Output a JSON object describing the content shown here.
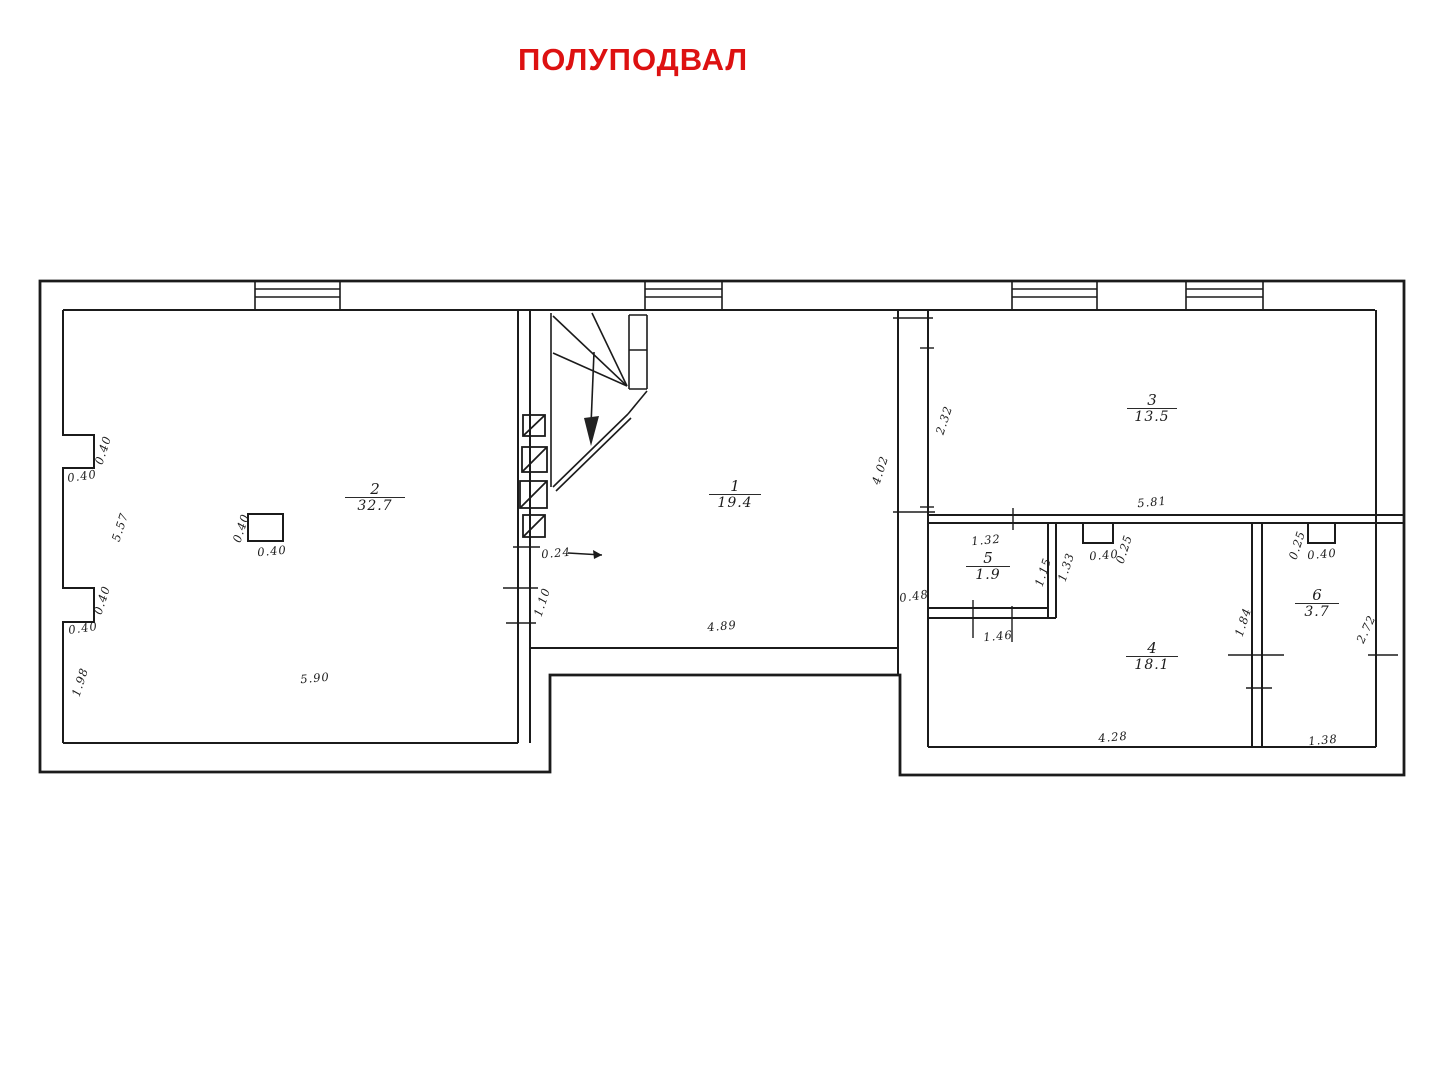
{
  "title": "ПОЛУПОДВАЛ",
  "colors": {
    "title_red": "#dd1111",
    "ink": "#1b1b1b",
    "background": "#ffffff"
  },
  "plan": {
    "floor_name": "ПОЛУПОДВАЛ",
    "rooms": [
      {
        "number": "1",
        "area": "19.4",
        "x": 735,
        "y": 495,
        "bar_w": 52
      },
      {
        "number": "2",
        "area": "32.7",
        "x": 375,
        "y": 498,
        "bar_w": 60
      },
      {
        "number": "3",
        "area": "13.5",
        "x": 1152,
        "y": 409,
        "bar_w": 50
      },
      {
        "number": "4",
        "area": "18.1",
        "x": 1152,
        "y": 657,
        "bar_w": 52
      },
      {
        "number": "5",
        "area": "1.9",
        "x": 988,
        "y": 567,
        "bar_w": 44
      },
      {
        "number": "6",
        "area": "3.7",
        "x": 1317,
        "y": 604,
        "bar_w": 44
      }
    ],
    "dimensions": [
      {
        "text": "0.40",
        "x": 103,
        "y": 450,
        "rot": -72
      },
      {
        "text": "0.40",
        "x": 82,
        "y": 476,
        "rot": -8
      },
      {
        "text": "5.57",
        "x": 120,
        "y": 527,
        "rot": -72
      },
      {
        "text": "0.40",
        "x": 102,
        "y": 600,
        "rot": -72
      },
      {
        "text": "0.40",
        "x": 83,
        "y": 628,
        "rot": -8
      },
      {
        "text": "1.98",
        "x": 80,
        "y": 682,
        "rot": -72
      },
      {
        "text": "5.90",
        "x": 315,
        "y": 678,
        "rot": -5
      },
      {
        "text": "0.40",
        "x": 241,
        "y": 528,
        "rot": -72
      },
      {
        "text": "0.40",
        "x": 272,
        "y": 551,
        "rot": -5
      },
      {
        "text": "0.24",
        "x": 556,
        "y": 553,
        "rot": -5
      },
      {
        "text": "1.10",
        "x": 542,
        "y": 602,
        "rot": -72
      },
      {
        "text": "4.02",
        "x": 880,
        "y": 470,
        "rot": -72
      },
      {
        "text": "4.89",
        "x": 722,
        "y": 626,
        "rot": -5
      },
      {
        "text": "0.48",
        "x": 914,
        "y": 596,
        "rot": -8
      },
      {
        "text": "2.32",
        "x": 944,
        "y": 420,
        "rot": -72
      },
      {
        "text": "5.81",
        "x": 1152,
        "y": 502,
        "rot": -5
      },
      {
        "text": "1.32",
        "x": 986,
        "y": 540,
        "rot": -5
      },
      {
        "text": "1.15",
        "x": 1043,
        "y": 572,
        "rot": -72
      },
      {
        "text": "1.33",
        "x": 1066,
        "y": 567,
        "rot": -72
      },
      {
        "text": "0.40",
        "x": 1104,
        "y": 555,
        "rot": -5
      },
      {
        "text": "0.25",
        "x": 1124,
        "y": 549,
        "rot": -72
      },
      {
        "text": "1.46",
        "x": 998,
        "y": 636,
        "rot": -5
      },
      {
        "text": "1.84",
        "x": 1243,
        "y": 622,
        "rot": -72
      },
      {
        "text": "0.25",
        "x": 1297,
        "y": 545,
        "rot": -72
      },
      {
        "text": "0.40",
        "x": 1322,
        "y": 554,
        "rot": -5
      },
      {
        "text": "2.72",
        "x": 1366,
        "y": 629,
        "rot": -65
      },
      {
        "text": "4.28",
        "x": 1113,
        "y": 737,
        "rot": -5
      },
      {
        "text": "1.38",
        "x": 1323,
        "y": 740,
        "rot": -5
      }
    ]
  }
}
